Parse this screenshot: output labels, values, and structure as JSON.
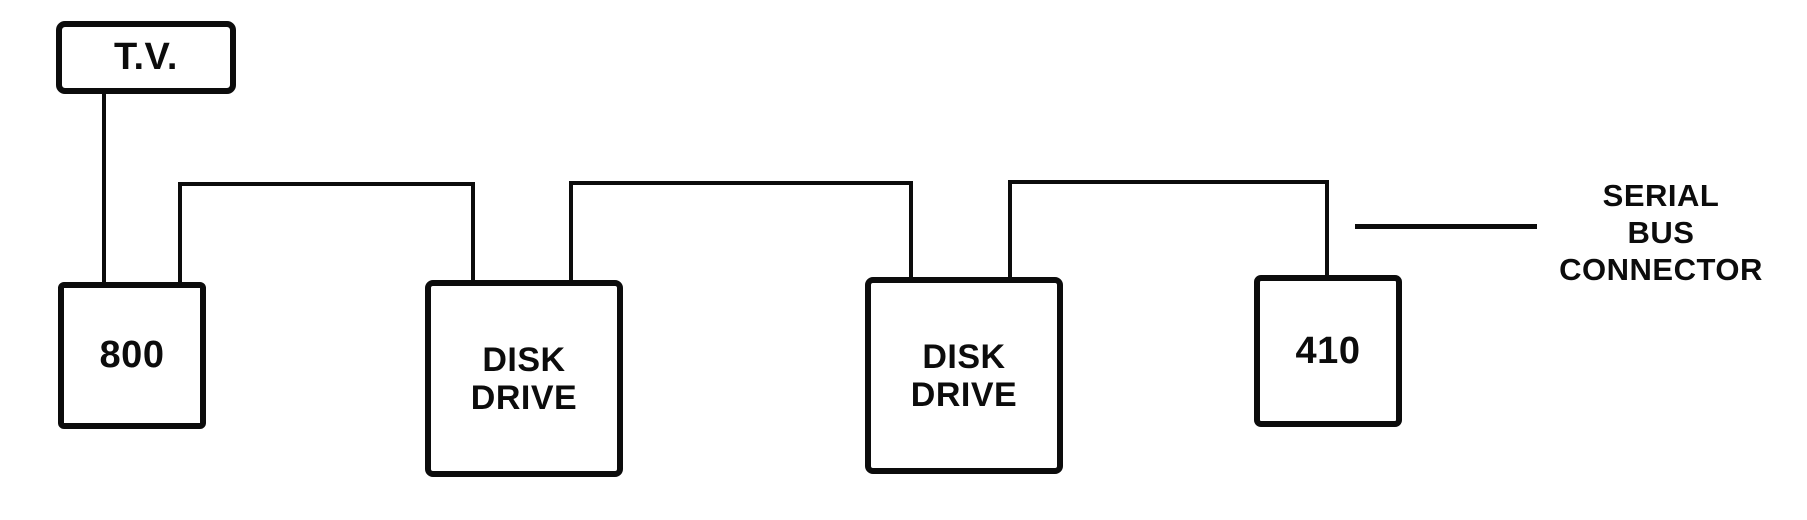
{
  "diagram": {
    "nodes": [
      {
        "id": "tv",
        "label": "T.V."
      },
      {
        "id": "computer-800",
        "label": "800"
      },
      {
        "id": "disk-drive-1",
        "label": "DISK\nDRIVE"
      },
      {
        "id": "disk-drive-2",
        "label": "DISK\nDRIVE"
      },
      {
        "id": "recorder-410",
        "label": "410"
      }
    ],
    "annotation": {
      "label": "SERIAL\nBUS\nCONNECTOR"
    },
    "connections": [
      {
        "from": "tv",
        "to": "computer-800"
      },
      {
        "from": "computer-800",
        "to": "disk-drive-1"
      },
      {
        "from": "disk-drive-1",
        "to": "disk-drive-2"
      },
      {
        "from": "disk-drive-2",
        "to": "recorder-410"
      }
    ],
    "colors": {
      "ink": "#0c0c0c",
      "background": "#ffffff"
    }
  }
}
